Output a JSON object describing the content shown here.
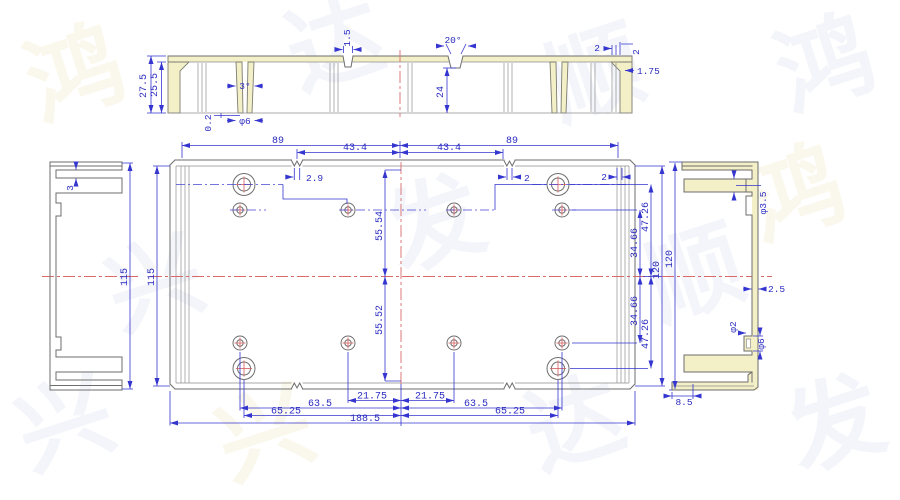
{
  "section": {
    "h27_5": "27.5",
    "h25_5": "25.5",
    "taper": "3°",
    "gap": "0.2",
    "boss_dia": "φ6",
    "notch15": "1.5",
    "angle20": "20°",
    "depth24": "24",
    "slot2a": "2",
    "slot2b": "2",
    "slot175": "1.75"
  },
  "plan": {
    "top_89_left": "89",
    "top_434_left": "43.4",
    "top_434_right": "43.4",
    "top_89_right": "89",
    "notch_29": "2.9",
    "notch_2": "2",
    "rib_2": "2",
    "left_115": "115",
    "v5554": "55.54",
    "v5552": "55.52",
    "r4726_top": "47.26",
    "r3466_top": "34.66",
    "r120": "120",
    "r3466_bot": "34.66",
    "r4726_bot": "47.26",
    "b2175_l": "21.75",
    "b2175_r": "21.75",
    "b635_l": "63.5",
    "b635_r": "63.5",
    "b6525_l": "65.25",
    "b6525_r": "65.25",
    "b1885": "188.5"
  },
  "left_view": {
    "gap3": "3",
    "h115": "115"
  },
  "right_view": {
    "dia35": "φ3.5",
    "wall25": "2.5",
    "dia2": "φ2",
    "dia6": "φ6",
    "lip85": "8.5",
    "h120": "120"
  },
  "colors": {
    "dimension": "#2b2bc0",
    "centerline": "#d96a6a",
    "material_fill": "#f3efc7",
    "outline": "#6e6e6e"
  },
  "watermark": {
    "items": [
      "鸿",
      "达",
      "兴",
      "发",
      "顺",
      "鸿",
      "达",
      "兴",
      "发",
      "顺",
      "鸿",
      "兴"
    ]
  }
}
